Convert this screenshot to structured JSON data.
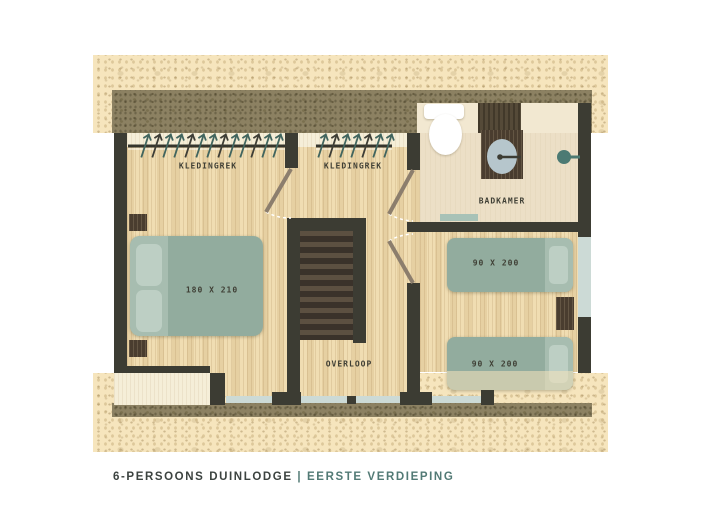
{
  "title_block": {
    "name": "6-PERSOONS DUINLODGE",
    "separator": "|",
    "floor": "EERSTE VERDIEPING"
  },
  "labels": {
    "closet_left": "KLEDINGREK",
    "closet_middle": "KLEDINGREK",
    "bathroom": "BADKAMER",
    "landing": "OVERLOOP",
    "bed_double": "180 X 210",
    "bed_single_top": "90 X 200",
    "bed_single_bottom": "90 X 200"
  },
  "icons": {
    "toilet": "toilet-icon",
    "sink": "sink-basin-icon",
    "shower": "shower-head-icon",
    "bath_mat": "bath-mat",
    "stairs": "staircase",
    "clothes_rail": "clothes-rail-with-hangers",
    "door_swing": "door-swing-arc",
    "window": "window-strip"
  },
  "colors": {
    "sand": "#f6e5bd",
    "roof_band": "#8c8162",
    "wall": "#3c3c33",
    "wood_floor": "#eed9ab",
    "bed_green": "#92ac9e",
    "window_blue": "#ccdad6",
    "accent_teal": "#527a75",
    "dark_wood": "#4a3d2f"
  }
}
